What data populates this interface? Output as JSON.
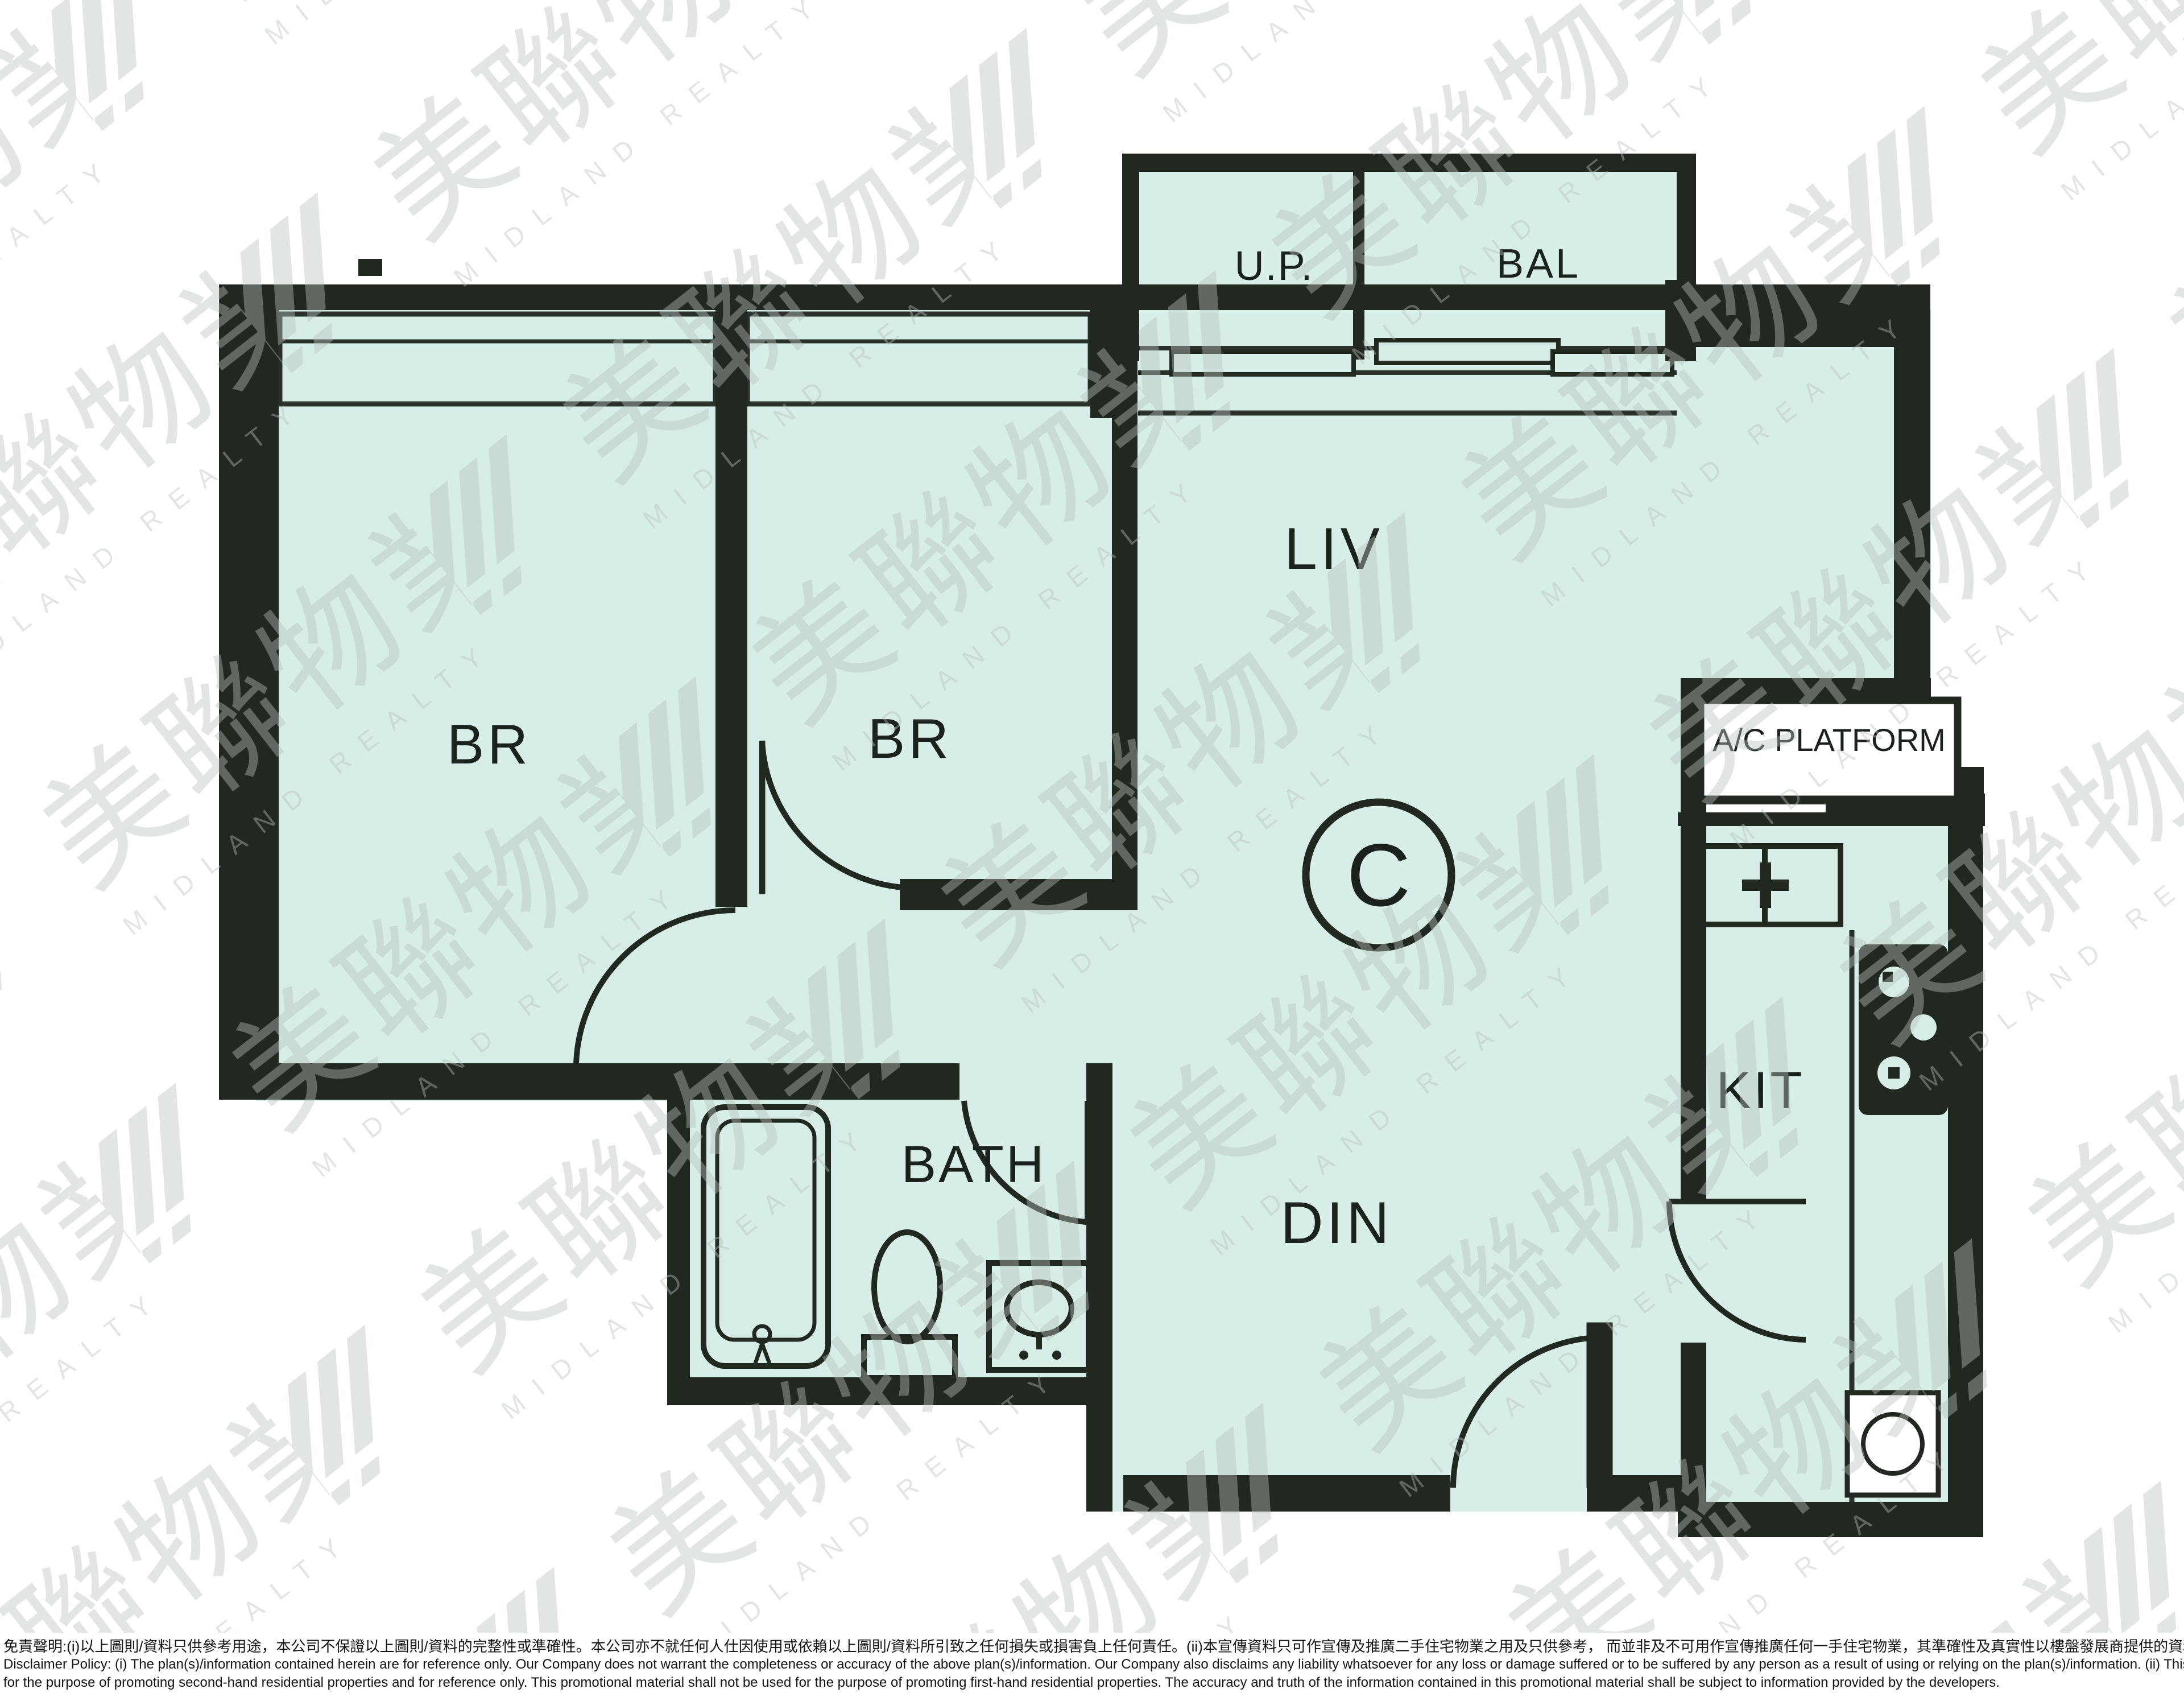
{
  "document": {
    "kind": "real-estate floor plan promotional sheet",
    "agency_logo": "Midland Realty watermark"
  },
  "unit": {
    "label": "C"
  },
  "rooms": {
    "br1": {
      "label": "BR"
    },
    "br2": {
      "label": "BR"
    },
    "liv": {
      "label": "LIV"
    },
    "din": {
      "label": "DIN"
    },
    "bath": {
      "label": "BATH"
    },
    "kit": {
      "label": "KIT"
    },
    "up": {
      "label": "U.P."
    },
    "bal": {
      "label": "BAL"
    },
    "ac_platform": {
      "label": "A/C PLATFORM"
    }
  },
  "watermark": {
    "cjk": "美聯物業",
    "en": "MIDLAND REALTY"
  },
  "colors": {
    "background": "#ffffff",
    "room_fill": "#d7ede7",
    "wall": "#20281f",
    "thin_line": "#28312a",
    "label_text": "#1b221e",
    "watermark": "#b6c0bc"
  },
  "disclaimer": {
    "zh": "免責聲明:(i)以上圖則/資料只供參考用途，本公司不保證以上圖則/資料的完整性或準確性。本公司亦不就任何人仕因使用或依賴以上圖則/資料所引致之任何損失或損害負上任何責任。(ii)本宣傳資料只可作宣傳及推廣二手住宅物業之用及只供參考， 而並非及不可用作宣傳推廣任何一手住宅物業，其準確性及真實性以樓盤發展商提供的資料為準。",
    "en_line1": "Disclaimer Policy: (i) The plan(s)/information contained herein are for reference only. Our Company does not warrant the completeness or accuracy of the above plan(s)/information. Our Company also disclaims any liability whatsoever for any loss or damage suffered or to be suffered by any person as a result of using or relying on the plan(s)/information. (ii) This promotional material is",
    "en_line2": "for the purpose of promoting second-hand residential properties and for reference only. This promotional material shall not be used for the purpose of promoting first-hand residential properties. The accuracy and truth of the information contained in this promotional material shall be subject to information provided by the developers."
  }
}
